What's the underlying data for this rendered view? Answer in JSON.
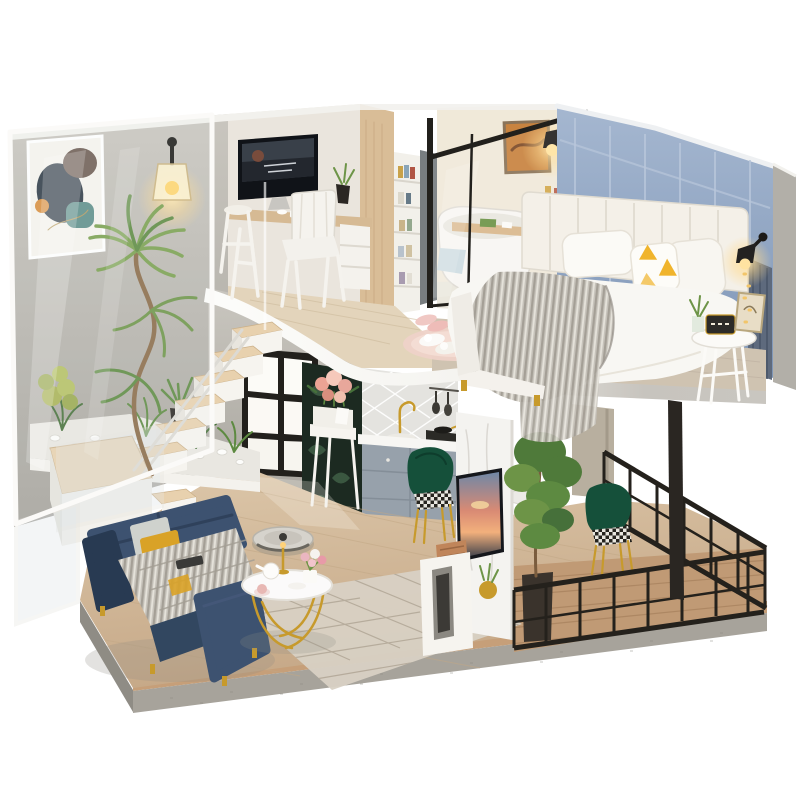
{
  "scene": {
    "description": "Miniature DIY dollhouse diorama: a two-story modern loft apartment on a white background. Upstairs: home office with monitor desk, glass-walled bathroom with tub and teal vanity, bedroom with white bed and grey knit throw. Downstairs: navy sofa with gold coffee table, robot vacuum, staircase with glass balustrade and plants, kitchen, dining nook with green velvet chairs, TV marble wall and a black-railing balcony.",
    "type": "product-photo"
  },
  "rooms": {
    "upper": [
      "home-office",
      "bathroom",
      "bedroom"
    ],
    "lower": [
      "living-room",
      "kitchen",
      "dining",
      "balcony",
      "staircase"
    ]
  },
  "objects": {
    "abstract_art": "abstract wall art",
    "wall_lamp": "glowing wall sconce",
    "monitor": "desktop monitor on desk",
    "desk_chair": "white quilted chair",
    "bookshelf": "white bookshelf",
    "bathtub": "white tub with wood caddy",
    "vanity": "teal bathroom vanity with mirror",
    "bed": "white bed with grey knit blanket and yellow triangle pillow",
    "side_table": "round bedside table with alarm clock",
    "slippers": "slippers on pink mat",
    "window": "black-framed window",
    "console_flowers": "white console with peach roses",
    "kitchen": "grey kitchen cabinets with gold faucet",
    "dining_chairs": "dark green velvet chairs with gold legs",
    "tv_wall": "white marble media wall with sunset TV",
    "balcony": "black metal railing balcony",
    "sofa": "navy velvet sofa",
    "coffee_table": "round gold-leg coffee table",
    "robot_vacuum": "robot vacuum disc",
    "stairs": "wood-tread staircase with glass balustrade",
    "tall_plant": "twisted-trunk houseplant",
    "acrylic_panel": "clear acrylic front cover"
  },
  "palette": {
    "bg": "#ffffff",
    "white_paint": "#f5f3ee",
    "silver_wall": "#b7b4ad",
    "silver_wall_light": "#cdcac3",
    "office_wall": "#eae5dd",
    "bath_wall": "#f0e9d9",
    "blue_wall": "#93a7c6",
    "blue_wall_dark": "#7e95b6",
    "blue_trim": "#b9c7db",
    "wood_partition": "#d9bd97",
    "desk_wood": "#d6ba94",
    "frame_black": "#22201c",
    "band_white": "#f8f7f3",
    "band_gray": "#c7c4be",
    "floor_wood": "#d6bfa2",
    "floor_wood_dark": "#c1a383",
    "office_floor": "#e3d4bb",
    "bedroom_floor": "#cfc3b1",
    "stair_tread": "#e8d1ae",
    "base_gray": "#a7a39b",
    "base_wood": "#c69f79",
    "sofa_navy": "#324760",
    "sofa_navy_dark": "#283a52",
    "sofa_navy_light": "#3d5270",
    "blanket_gray": "#c3bfb7",
    "blanket_line": "#a29d94",
    "rug": "#d8d1c4",
    "rug_line": "#b3a898",
    "gold": "#c79a2c",
    "green_chair": "#15503a",
    "vanity_teal": "#1e5950",
    "plant_green": "#6d9447",
    "plant_dark": "#46703a",
    "plant_light": "#93b35e",
    "flower_pink": "#eba394",
    "flower_light": "#f6c9bb",
    "mat_pink": "#eed2c8",
    "pillow_yellow": "#f0b42c",
    "tv_frame": "#15171c",
    "marble": "#f4f3f0",
    "marble_vein": "#d8d5cf",
    "railing_black": "#24211c",
    "deck_wood": "#c09a75",
    "curtain": "#5e6a7d",
    "glow": "#ffd98c",
    "tile": "#e4e3df",
    "cabinet_gray": "#97a1ab",
    "botanical_dark": "#1c2a21",
    "botanical_leaf": "#3e5c44",
    "vacuum": "#d6d3cc",
    "clock_dark": "#2c2b28",
    "speaker_wood": "#c0855a"
  }
}
